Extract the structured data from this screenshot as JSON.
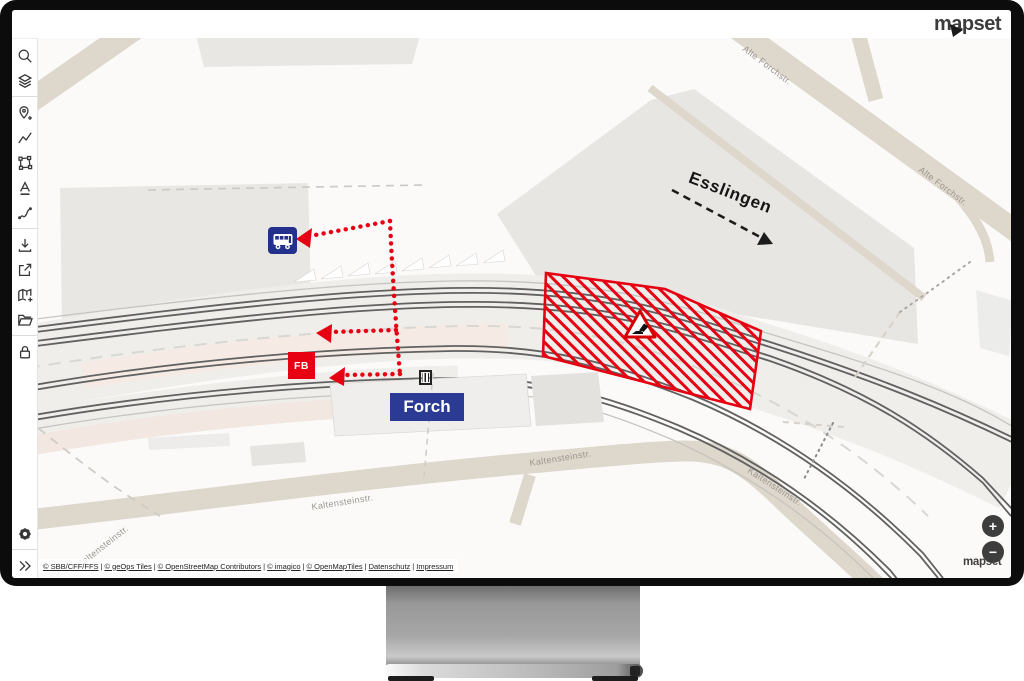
{
  "window": {
    "brand": "mapset"
  },
  "sidebar": {
    "tools": [
      {
        "id": "search",
        "icon": "search-icon"
      },
      {
        "id": "layers",
        "icon": "layers-icon"
      },
      {
        "id": "add-location",
        "icon": "pin-plus-icon"
      },
      {
        "id": "draw-line",
        "icon": "polyline-icon"
      },
      {
        "id": "draw-polygon",
        "icon": "polygon-icon"
      },
      {
        "id": "add-text",
        "icon": "text-icon"
      },
      {
        "id": "draw-route",
        "icon": "curve-icon"
      },
      {
        "id": "download",
        "icon": "download-icon"
      },
      {
        "id": "export",
        "icon": "share-icon"
      },
      {
        "id": "add-map",
        "icon": "map-plus-icon"
      },
      {
        "id": "open-folder",
        "icon": "folder-icon"
      },
      {
        "id": "lock",
        "icon": "lock-icon"
      },
      {
        "id": "settings",
        "icon": "gear-icon"
      },
      {
        "id": "expand",
        "icon": "double-chevron-icon"
      }
    ]
  },
  "map": {
    "labels": {
      "esslingen": "Esslingen",
      "forch": "Forch",
      "fb": "FB",
      "alte_forchstr": "Alte Forchstr.",
      "kaltensteinstr": "Kaltensteinstr."
    },
    "controls": {
      "zoom_in": "+",
      "zoom_out": "−"
    },
    "watermark": "mapset",
    "attribution": {
      "links": [
        "© SBB/CFF/FFS",
        "© geOps Tiles",
        "© OpenStreetMap Contributors",
        "© imagico",
        "© OpenMapTiles",
        "Datenschutz",
        "Impressum"
      ]
    },
    "colors": {
      "annotation_red": "#e60012",
      "annotation_navy": "#2b3a92",
      "road_beige": "#ded7cc",
      "building_gray": "#e9e7e3"
    }
  }
}
